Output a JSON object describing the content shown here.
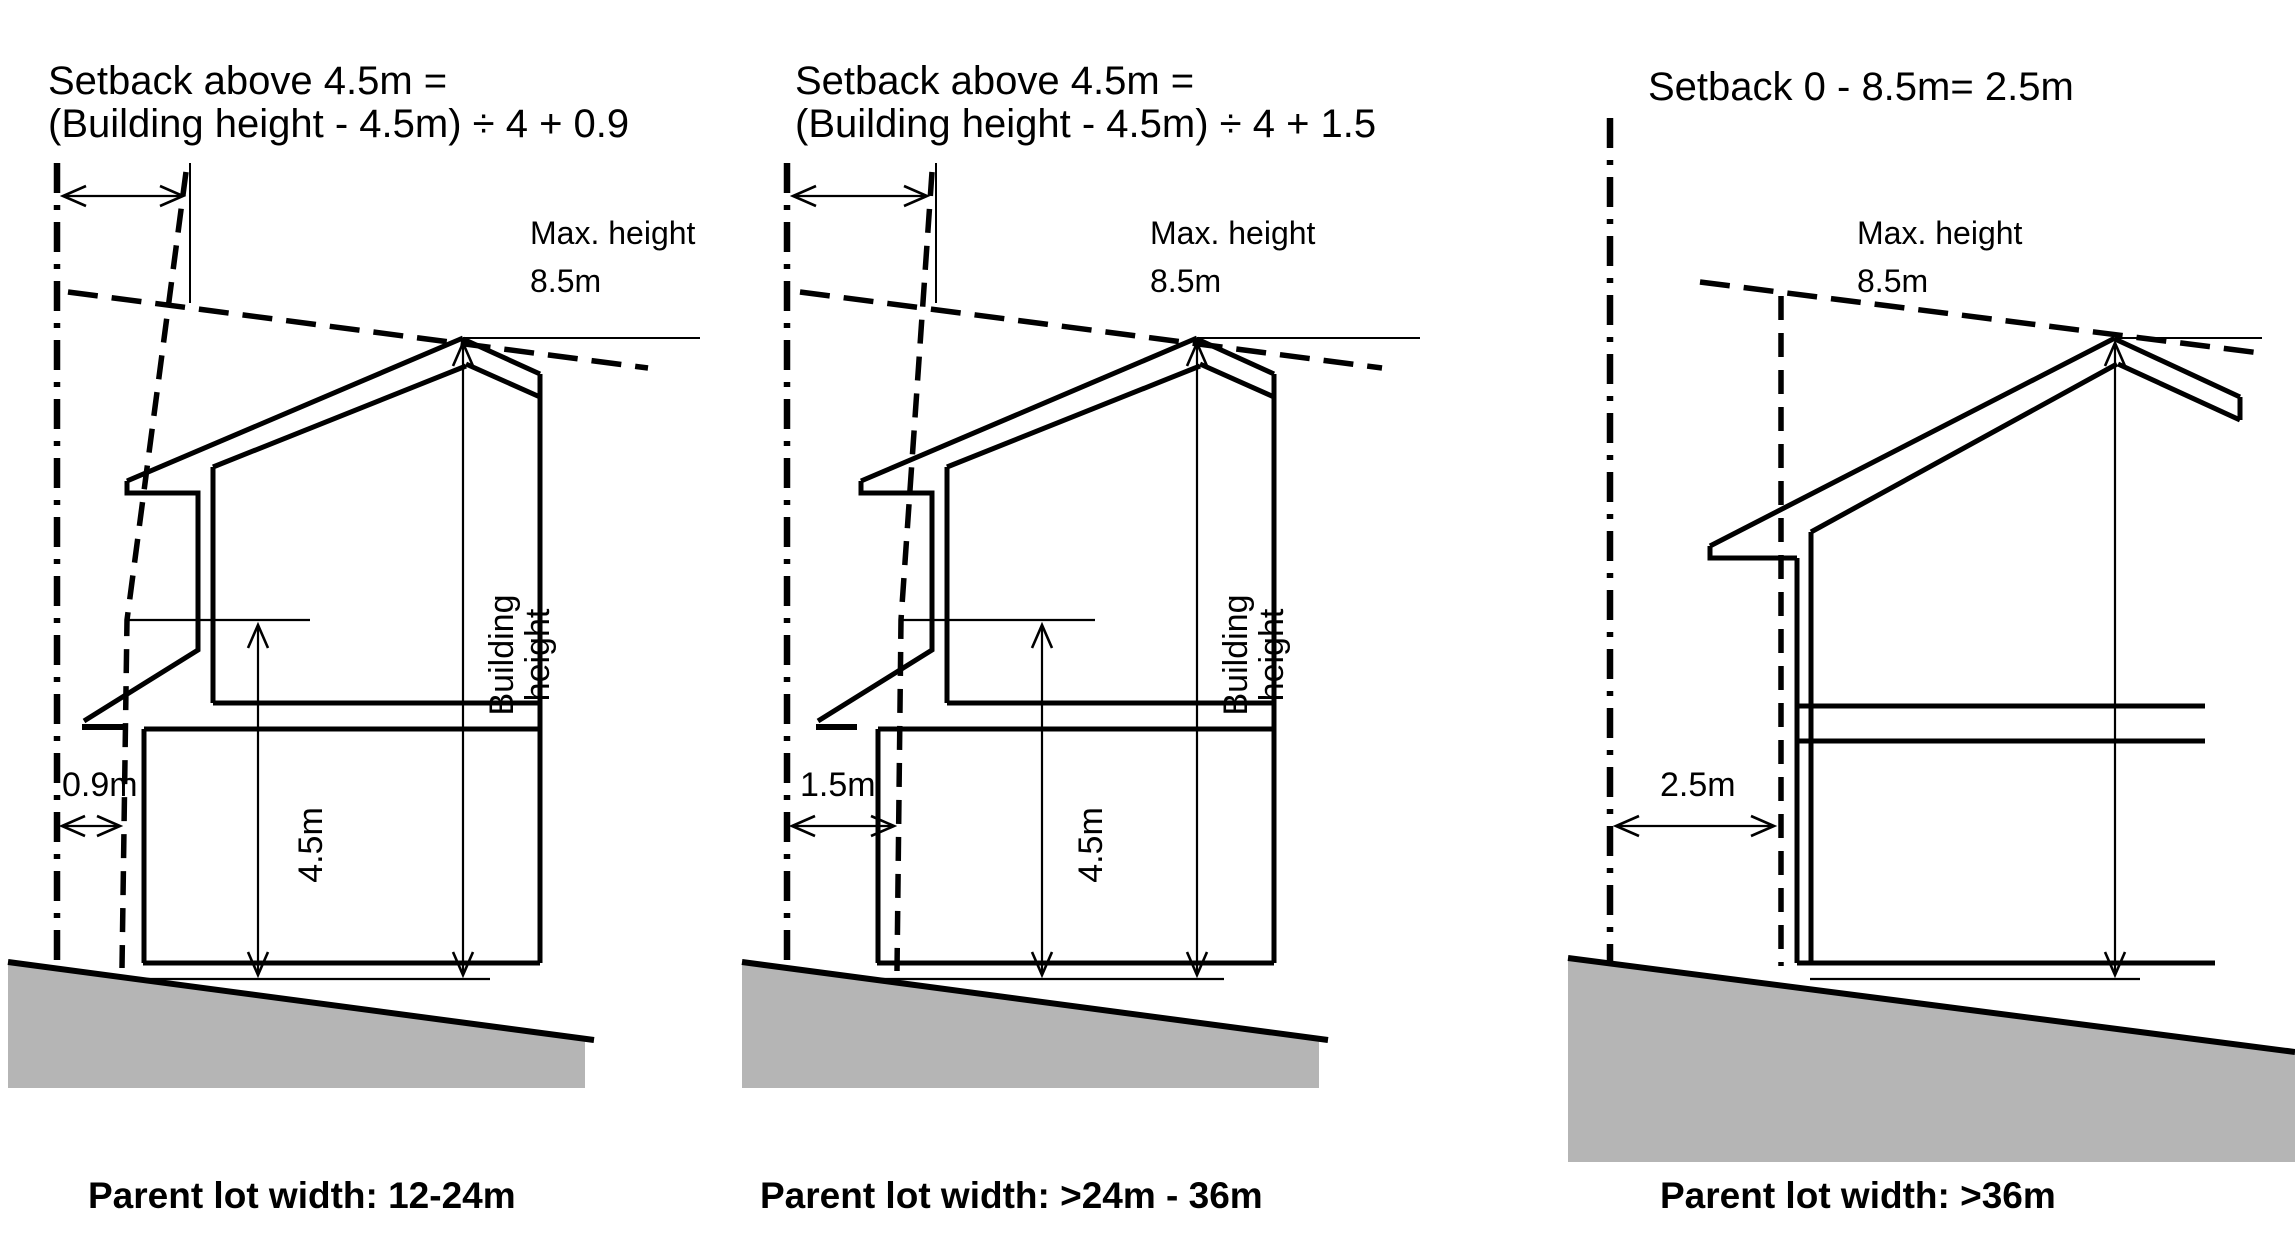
{
  "colors": {
    "background": "#ffffff",
    "line": "#000000",
    "ground_fill": "#b5b5b5"
  },
  "panels": [
    {
      "id": "parent-lot-12-24m",
      "formula_line1": "Setback above 4.5m =",
      "formula_line2": "(Building height - 4.5m) ÷ 4 + 0.9",
      "max_height_label": "Max. height",
      "max_height_value": "8.5m",
      "building_height_line1": "Building",
      "building_height_line2": "height",
      "level_label": "4.5m",
      "ground_setback_label": "0.9m",
      "parent_lot_label": "Parent lot width: 12-24m"
    },
    {
      "id": "parent-lot-24-36m",
      "formula_line1": "Setback above 4.5m =",
      "formula_line2": "(Building height - 4.5m) ÷ 4 + 1.5",
      "max_height_label": "Max. height",
      "max_height_value": "8.5m",
      "building_height_line1": "Building",
      "building_height_line2": "height",
      "level_label": "4.5m",
      "ground_setback_label": "1.5m",
      "parent_lot_label": "Parent lot width: >24m - 36m"
    },
    {
      "id": "parent-lot-over-36m",
      "formula_line1": "Setback 0 - 8.5m= 2.5m",
      "max_height_label": "Max. height",
      "max_height_value": "8.5m",
      "ground_setback_label": "2.5m",
      "parent_lot_label": "Parent lot width: >36m"
    }
  ]
}
